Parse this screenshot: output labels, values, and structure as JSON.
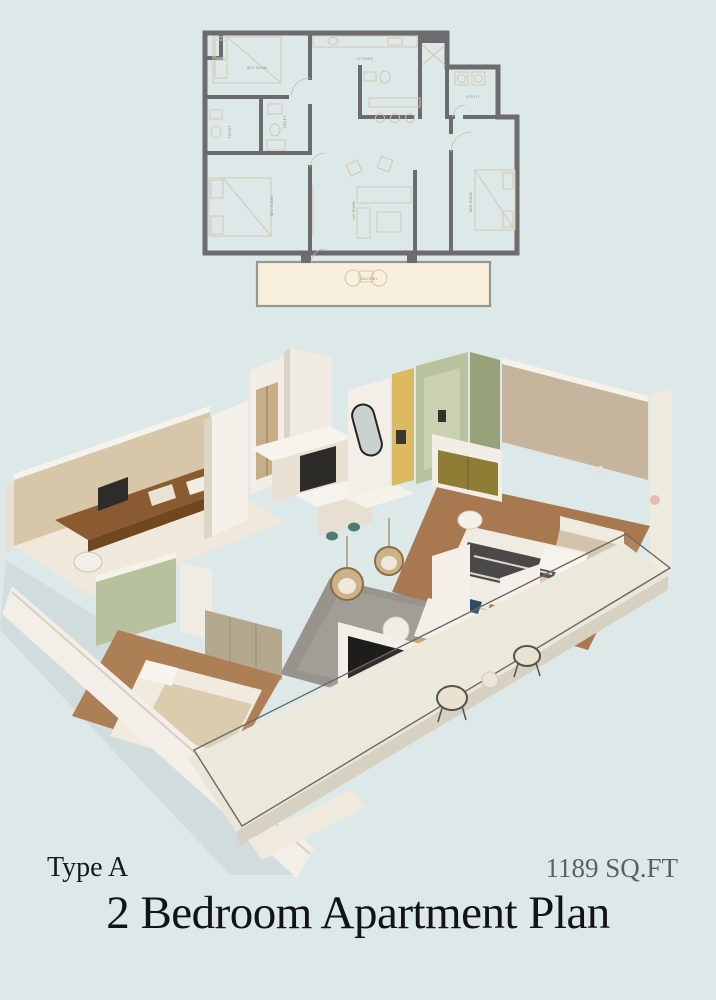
{
  "page": {
    "background_color": "#dde9e9"
  },
  "floor_plan_2d": {
    "wall_color": "#6b6b70",
    "floor_color": "#f8efdc",
    "furniture_line_color": "#d3c7ae",
    "labels": [
      {
        "text": "BED ROOM"
      },
      {
        "text": "TOILET"
      },
      {
        "text": "TOILET"
      },
      {
        "text": "KITCHEN"
      },
      {
        "text": "UTILITY"
      },
      {
        "text": "BED ROOM"
      },
      {
        "text": "LIV ROOM"
      },
      {
        "text": "BED ROOM"
      },
      {
        "text": "BALCONY"
      }
    ]
  },
  "render_3d": {
    "palette": {
      "wall_white": "#f3efe8",
      "wood_wall": "#d8c6a8",
      "wood_floor": "#ad7f55",
      "sage_green": "#b8c19e",
      "olive_green": "#97a27a",
      "mustard_tile": "#dcba62",
      "desk_brown": "#8a5a30",
      "rug_gray": "#96948c",
      "tv_black": "#1e1d1b",
      "duvet_dark": "#4b4947",
      "brass_gold": "#8f7c35"
    }
  },
  "footer": {
    "type_label": "Type A",
    "area_label": "1189 SQ.FT",
    "title": "2 Bedroom Apartment Plan"
  }
}
